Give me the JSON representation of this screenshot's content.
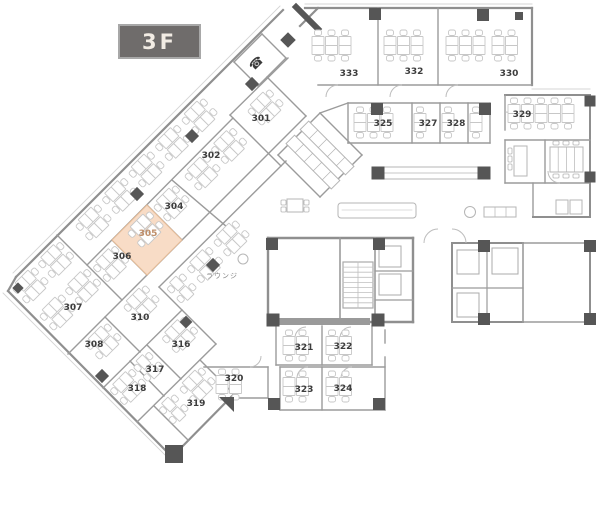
{
  "floor_badge": {
    "label": "3F"
  },
  "theme": {
    "background": "#ffffff",
    "wall_color": "#8f8f8f",
    "inner_wall_color": "#9b9b9b",
    "dark_wall_color": "#565656",
    "desk_color": "#c7c7c7",
    "furniture_color": "#b5b5b5",
    "room_label_color": "#3d3d3d",
    "highlight_fill": "#f8dcc6",
    "highlight_stroke": "#e5bb97",
    "highlight_label_color": "#bf8f6b",
    "badge_bg": "#6f6c6b",
    "badge_border": "#a8a8a8",
    "badge_text_color": "#f2ece4",
    "lounge_label_color": "#8a8a8a"
  },
  "icons": {
    "phone_glyph": "☎"
  },
  "lounge": {
    "label": "ラウンジ",
    "x": 222,
    "y": 278
  },
  "phone_booth": {
    "x": 259,
    "y": 66
  },
  "highlighted_room": {
    "number": "305",
    "polygon": [
      [
        147,
        205
      ],
      [
        182,
        240
      ],
      [
        147,
        275
      ],
      [
        112,
        240
      ]
    ]
  },
  "rooms": [
    {
      "number": "301",
      "x": 261,
      "y": 121
    },
    {
      "number": "302",
      "x": 211,
      "y": 158
    },
    {
      "number": "304",
      "x": 174,
      "y": 209
    },
    {
      "number": "305",
      "x": 148,
      "y": 236,
      "highlighted": true
    },
    {
      "number": "306",
      "x": 122,
      "y": 259
    },
    {
      "number": "307",
      "x": 73,
      "y": 310
    },
    {
      "number": "308",
      "x": 94,
      "y": 347
    },
    {
      "number": "310",
      "x": 140,
      "y": 320
    },
    {
      "number": "316",
      "x": 181,
      "y": 347
    },
    {
      "number": "317",
      "x": 155,
      "y": 372
    },
    {
      "number": "318",
      "x": 137,
      "y": 391
    },
    {
      "number": "319",
      "x": 196,
      "y": 406
    },
    {
      "number": "320",
      "x": 234,
      "y": 381
    },
    {
      "number": "321",
      "x": 304,
      "y": 350
    },
    {
      "number": "322",
      "x": 343,
      "y": 349
    },
    {
      "number": "323",
      "x": 304,
      "y": 392
    },
    {
      "number": "324",
      "x": 343,
      "y": 391
    },
    {
      "number": "325",
      "x": 383,
      "y": 126
    },
    {
      "number": "327",
      "x": 428,
      "y": 126
    },
    {
      "number": "328",
      "x": 456,
      "y": 126
    },
    {
      "number": "329",
      "x": 522,
      "y": 117
    },
    {
      "number": "330",
      "x": 509,
      "y": 76
    },
    {
      "number": "332",
      "x": 414,
      "y": 74
    },
    {
      "number": "333",
      "x": 349,
      "y": 76
    }
  ]
}
